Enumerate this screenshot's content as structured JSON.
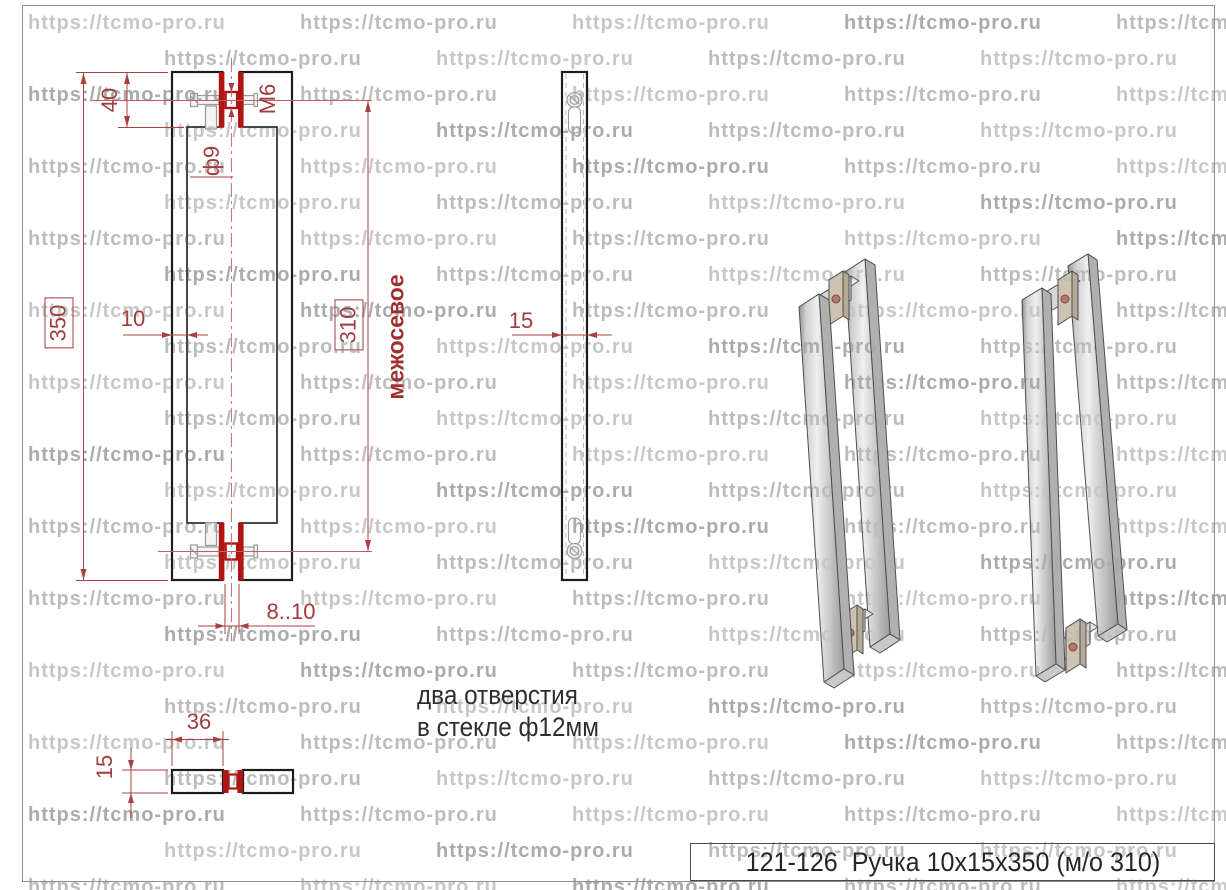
{
  "watermark": {
    "text": "https://tcmo-pro.ru",
    "shades": [
      "#c7c7c7",
      "#bcbcbc",
      "#ababab"
    ]
  },
  "front_view": {
    "dim_top_offset": "40",
    "dim_thread": "M6",
    "dim_hole_diameter": "ф9",
    "dim_overall_length": "350",
    "dim_bar_width": "10",
    "dim_hole_spacing": "310",
    "axis_label": "межосевое",
    "dim_glass_thickness": "8..10"
  },
  "side_view": {
    "dim_depth": "15"
  },
  "top_view": {
    "dim_post_length": "36",
    "dim_post_height": "15"
  },
  "note": {
    "line1": "два отверстия",
    "line2": "в стекле ф12мм"
  },
  "title_block": {
    "text": "121-126  Ручка 10х15х350 (м/о 310)"
  },
  "colors": {
    "dimension": "#a03c3c",
    "glass_pad": "#b01515",
    "outline": "#1c1c1c"
  }
}
